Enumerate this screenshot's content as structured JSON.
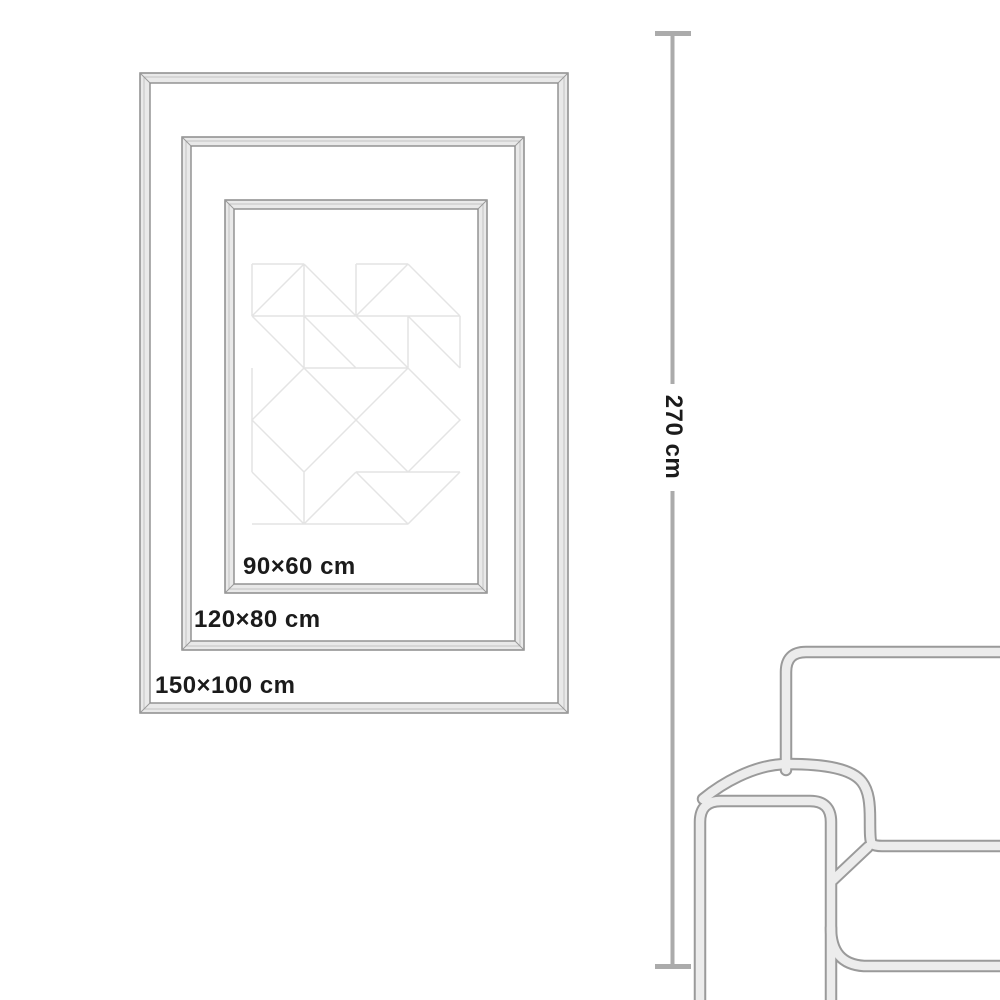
{
  "page": {
    "type": "poster-size-guide-illustration",
    "background": "#ffffff"
  },
  "frames": [
    {
      "id": "frame-90x60",
      "label": "90×60 cm",
      "width_cm": 90,
      "height_cm": 60
    },
    {
      "id": "frame-120x80",
      "label": "120×80 cm",
      "width_cm": 120,
      "height_cm": 80
    },
    {
      "id": "frame-150x100",
      "label": "150×100 cm",
      "width_cm": 150,
      "height_cm": 100
    }
  ],
  "ceiling_height": {
    "label": "270 cm",
    "value_cm": 270,
    "orientation": "vertical"
  },
  "poster": {
    "artwork": "faint geometric triangle quilt pattern"
  },
  "sofa": {
    "description": "outline illustration of a sofa armrest, backrest and seat, partially visible at bottom right"
  },
  "colors": {
    "frame_outline": "#8c8c8c",
    "frame_fill": "#e9e9e9",
    "pattern_line": "#e4e4e4",
    "sofa_outline": "#9a9a9a",
    "sofa_fill": "#ececec",
    "dimension_line": "#ababab",
    "label_text": "#1b1b1b"
  }
}
